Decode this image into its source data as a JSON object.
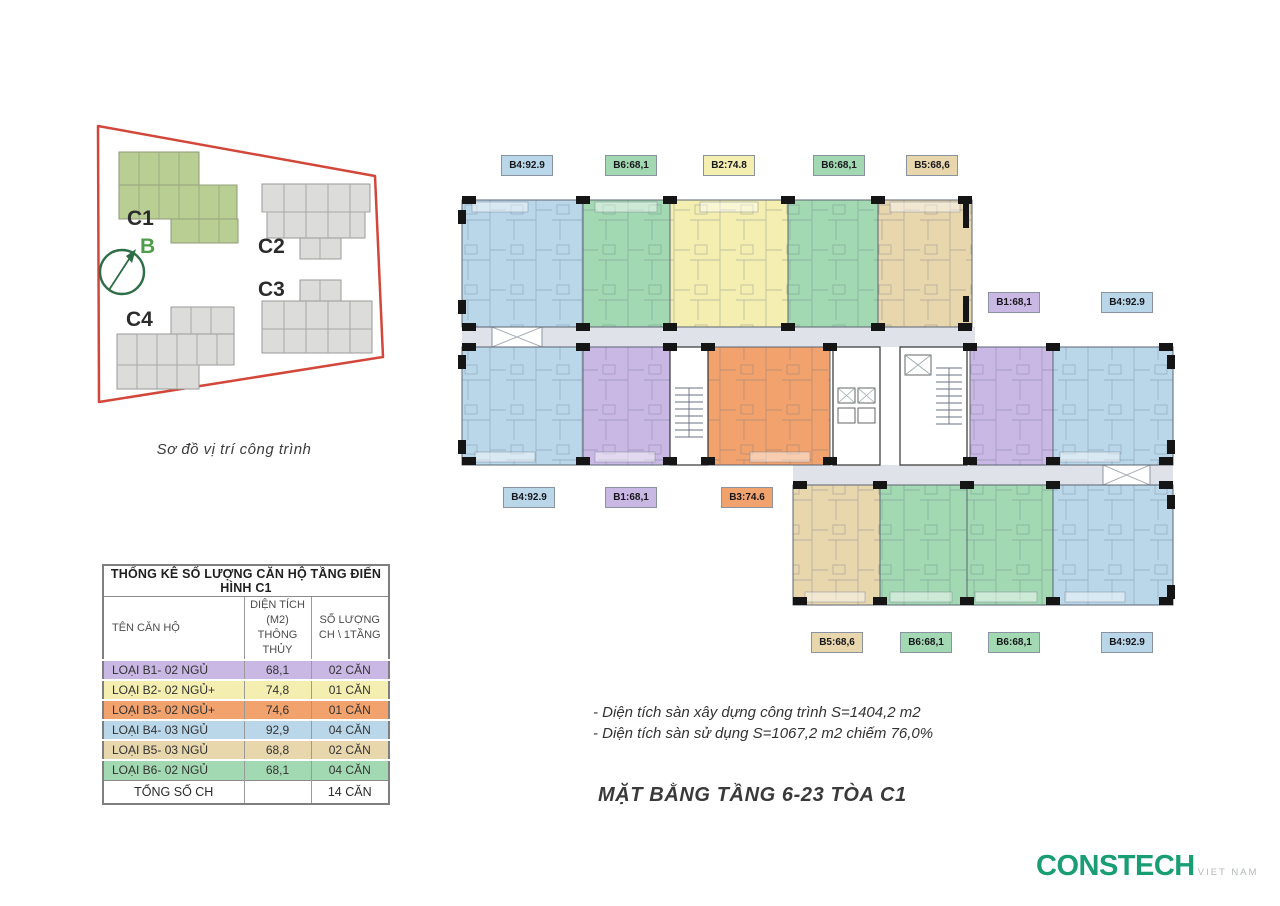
{
  "colors": {
    "blue": "#bad7ea",
    "green": "#a3d9b2",
    "yellow": "#f4eeb0",
    "purple": "#cab8e4",
    "orange": "#f2a26d",
    "tan": "#e8d6ad",
    "corridor": "#dfe2e8",
    "boundary_red": "#d2473a",
    "site_green": "#b9ce92",
    "site_gray": "#dcdcda",
    "compass_green": "#2d6e46",
    "logo_green": "#199d72",
    "text_dark": "#3d3d3d"
  },
  "site": {
    "caption": "Sơ đồ vị trí công trình",
    "compass_label": "B",
    "buildings": [
      {
        "label": "C1",
        "highlighted": true
      },
      {
        "label": "C2",
        "highlighted": false
      },
      {
        "label": "C3",
        "highlighted": false
      },
      {
        "label": "C4",
        "highlighted": false
      }
    ]
  },
  "plan": {
    "chips": {
      "top": [
        {
          "code": "B4:92.9",
          "color": "blue"
        },
        {
          "code": "B6:68,1",
          "color": "green"
        },
        {
          "code": "B2:74.8",
          "color": "yellow"
        },
        {
          "code": "B6:68,1",
          "color": "green"
        },
        {
          "code": "B5:68,6",
          "color": "tan"
        }
      ],
      "right": [
        {
          "code": "B1:68,1",
          "color": "purple"
        },
        {
          "code": "B4:92.9",
          "color": "blue"
        }
      ],
      "left": [
        {
          "code": "B4:92.9",
          "color": "blue"
        },
        {
          "code": "B1:68,1",
          "color": "purple"
        },
        {
          "code": "B3:74.6",
          "color": "orange"
        }
      ],
      "bottom": [
        {
          "code": "B5:68,6",
          "color": "tan"
        },
        {
          "code": "B6:68,1",
          "color": "green"
        },
        {
          "code": "B6:68,1",
          "color": "green"
        },
        {
          "code": "B4:92.9",
          "color": "blue"
        }
      ]
    }
  },
  "table": {
    "title": "THỐNG KÊ SỐ LƯỢNG CĂN HỘ TẦNG ĐIỂN HÌNH C1",
    "headers": {
      "name": "TÊN CĂN HỘ",
      "area_line1": "DIỆN TÍCH (M2)",
      "area_line2": "THÔNG THỦY",
      "count_line1": "SỐ LƯỢNG",
      "count_line2": "CH \\ 1TẦNG"
    },
    "rows": [
      {
        "name": "LOẠI B1- 02 NGỦ",
        "area": "68,1",
        "count": "02 CĂN",
        "color": "purple"
      },
      {
        "name": "LOẠI B2- 02 NGỦ+",
        "area": "74,8",
        "count": "01 CĂN",
        "color": "yellow"
      },
      {
        "name": "LOẠI B3- 02 NGỦ+",
        "area": "74,6",
        "count": "01 CĂN",
        "color": "orange"
      },
      {
        "name": "LOẠI B4- 03 NGỦ",
        "area": "92,9",
        "count": "04 CĂN",
        "color": "blue"
      },
      {
        "name": "LOẠI B5- 03 NGỦ",
        "area": "68,8",
        "count": "02 CĂN",
        "color": "tan"
      },
      {
        "name": "LOẠI B6- 02 NGỦ",
        "area": "68,1",
        "count": "04 CĂN",
        "color": "green"
      }
    ],
    "footer": {
      "label": "TỔNG SỐ CH",
      "count": "14 CĂN"
    }
  },
  "notes": {
    "line1": "- Diện tích sàn xây dựng công trình S=1404,2 m2",
    "line2": "- Diện tích sàn sử dụng S=1067,2 m2 chiếm 76,0%"
  },
  "title": "MẶT BẰNG TẦNG 6-23 TÒA C1",
  "logo": {
    "name": "CONSTECH",
    "sub": "VIET NAM"
  }
}
